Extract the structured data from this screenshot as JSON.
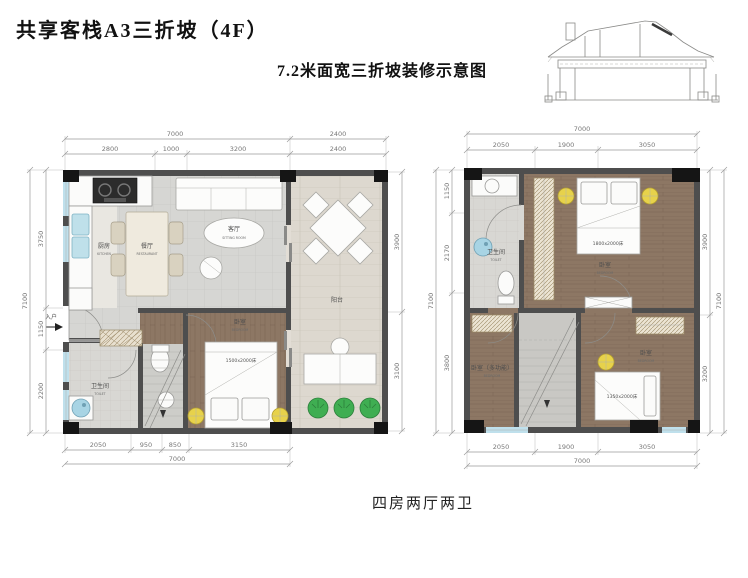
{
  "header": {
    "title": "共享客栈A3三折坡（4F）",
    "subtitle": "7.2米面宽三折坡装修示意图"
  },
  "footer": {
    "unit_type": "四房两厅两卫"
  },
  "colors": {
    "lamp": "#e7d24b",
    "plant": "#3fae52",
    "window": "#bfe0ec",
    "wood": "#8d7764",
    "wall": "#4e4e4e"
  },
  "lp": {
    "name": "下层平面图",
    "room": {
      "kitchen_zh": "厨房",
      "kitchen_en": "KITCHEN",
      "dining_zh": "餐厅",
      "dining_en": "RESTAURANT",
      "living_zh": "客厅",
      "living_en": "SITTING ROOM",
      "balcony_zh": "阳台",
      "bedroom_zh": "卧室",
      "bedroom_en": "BEDROOM",
      "bed_size": "1500x2000床",
      "toilet_zh": "卫生间",
      "toilet_en": "TOILET",
      "entry_zh": "入户"
    },
    "dim": {
      "top_total": "7000",
      "top_balcony": "2400",
      "t1": "2800",
      "t2": "1000",
      "t3": "3200",
      "t4": "2400",
      "b1": "2050",
      "b2": "950",
      "b3": "850",
      "b4": "3150",
      "bottom_total": "7000",
      "l1": "3750",
      "l2": "1150",
      "l3": "2200",
      "left_total": "7100",
      "r1": "3900",
      "r2": "3100"
    }
  },
  "rp": {
    "name": "上层平面图",
    "room": {
      "toilet_zh": "卫生间",
      "toilet_en": "TOILET",
      "master_zh": "卧室",
      "master_en": "BEDROOM",
      "master_bed": "1800x2000床",
      "multi_zh": "卧室（多功能）",
      "multi_en": "BEDROOM",
      "small_zh": "卧室",
      "small_en": "BEDROOM",
      "small_bed": "1350x2000床"
    },
    "dim": {
      "top_total": "7000",
      "t1": "2050",
      "t2": "1900",
      "t3": "3050",
      "b1": "2050",
      "b2": "1900",
      "b3": "3050",
      "bottom_total": "7000",
      "l1": "1150",
      "l2": "2170",
      "l3": "3800",
      "left_total": "7100",
      "r1": "3900",
      "r2": "3200",
      "right_total": "7100"
    }
  }
}
